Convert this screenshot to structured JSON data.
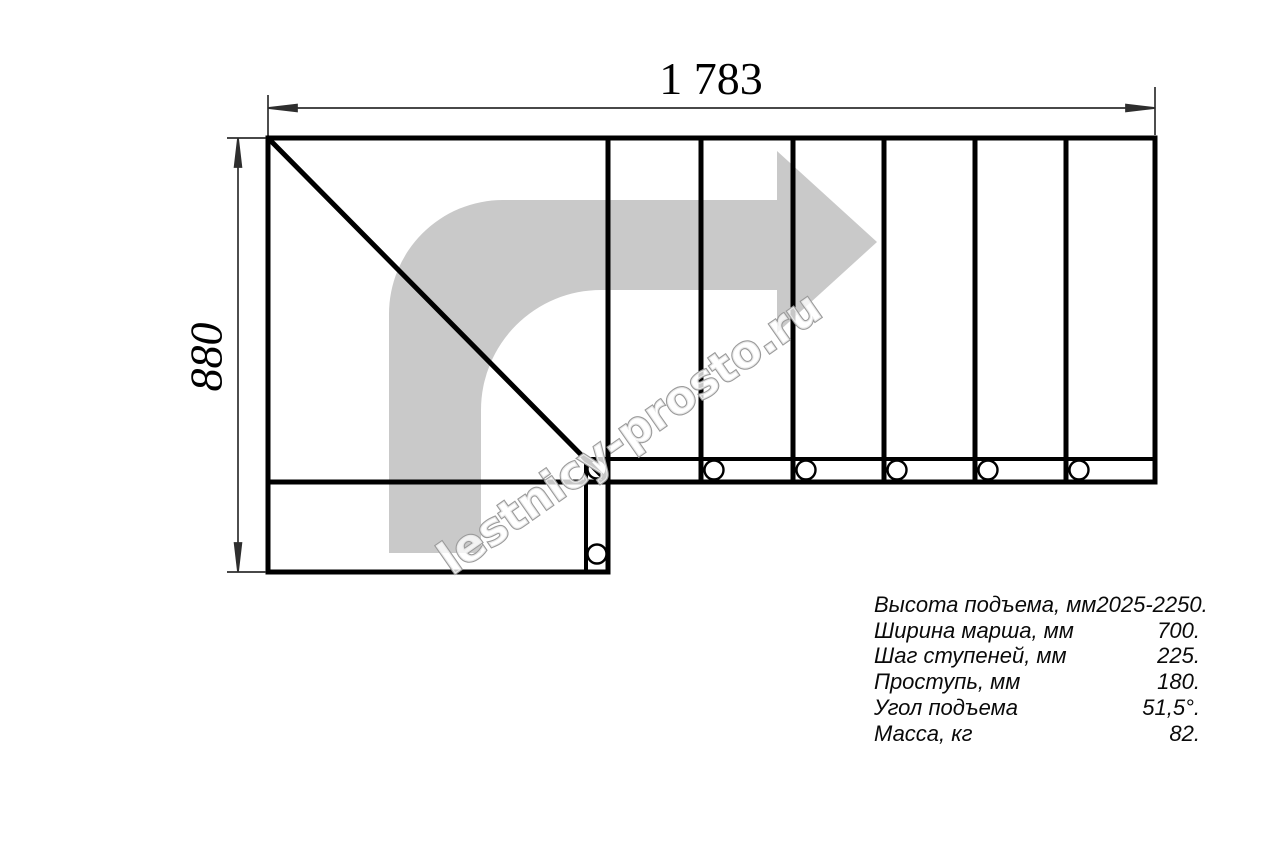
{
  "drawing": {
    "dimensions": {
      "width_label": "1 783",
      "height_label": "880"
    },
    "watermark": {
      "text": "lestnicy-prosto.ru"
    },
    "colors": {
      "line": "#000000",
      "dimension": "#2e2e2e",
      "arrow_fill": "#c9c9c9",
      "watermark_fill": "#ffffff",
      "watermark_outline": "#9a9a9a"
    }
  },
  "specs": {
    "rows": [
      {
        "label": "Высота подъема, мм",
        "value": "2025-2250."
      },
      {
        "label": "Ширина марша, мм",
        "value": "700."
      },
      {
        "label": "Шаг ступеней, мм",
        "value": "225."
      },
      {
        "label": "Проступь, мм",
        "value": "180."
      },
      {
        "label": "Угол подъема",
        "value": "51,5°."
      },
      {
        "label": "Масса, кг",
        "value": "82."
      }
    ]
  }
}
